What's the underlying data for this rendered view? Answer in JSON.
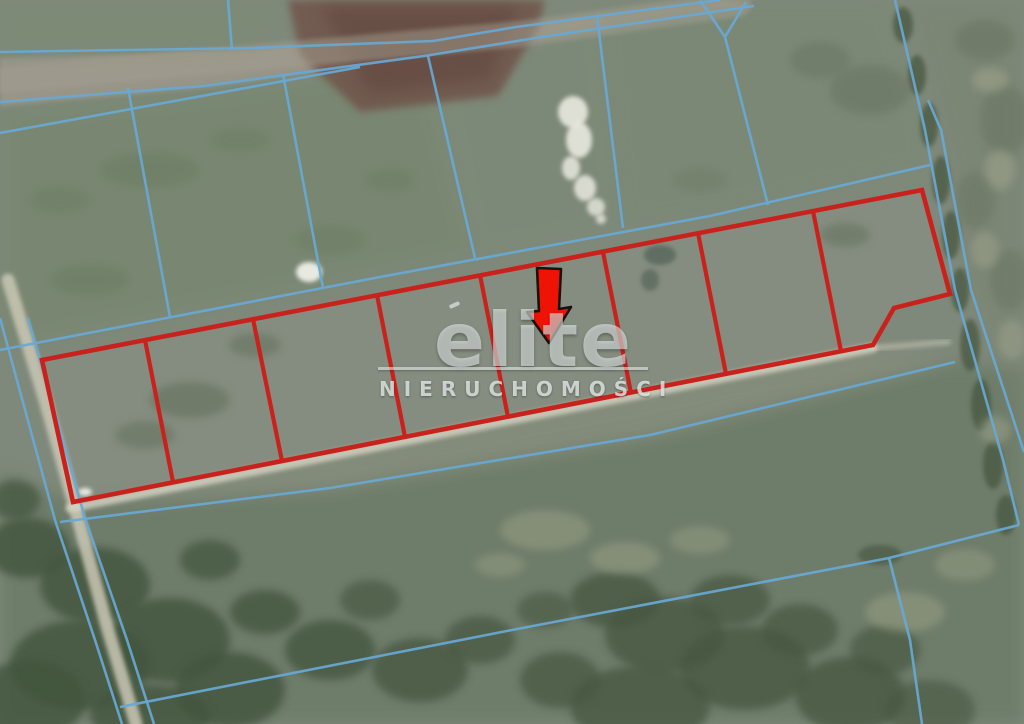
{
  "watermark": {
    "brand": "elite",
    "subtitle": "NIERUCHOMOŚCI"
  },
  "map": {
    "description": "aerial-photo-with-cadastral-overlay",
    "colors": {
      "cadastral": "#68a8d5",
      "parcel": "#c9221d",
      "arrow_fill": "#ef1306",
      "arrow_outline": "#18120c",
      "watermark": "#e6ebe9"
    },
    "parcels": {
      "count": 8,
      "arrow_parcel_index": 5,
      "outline": "42,360 922,190 950,294 894,308 873,345 73,502",
      "dividers": [
        "145,340 173,482",
        "253,319 282,461",
        "377,295 405,437",
        "480,275 508,417",
        "603,252 631,393",
        "698,233 726,374",
        "813,211 841,351"
      ]
    },
    "arrow": {
      "points": "537,268 561,269 559,309 571,307 549,343 527,312 539,311"
    },
    "terrain": {
      "base": "#7f897b",
      "patches": [
        {
          "name": "dirt-road",
          "pts": "0,58 250,50 520,26 722,0 754,6 548,38 424,58 204,88 0,106",
          "fill": "#9b978a",
          "op": 0.95,
          "blur": "b2"
        },
        {
          "name": "field-top-left",
          "pts": "0,112 210,90 425,60 475,255 170,318 0,352",
          "fill": "#75866b",
          "op": 0.5,
          "blur": "b8"
        },
        {
          "name": "field-mid",
          "pts": "428,56 600,16 623,228 475,258",
          "fill": "#7c8b74",
          "op": 0.4,
          "blur": "b8"
        },
        {
          "name": "field-right",
          "pts": "598,14 700,0 888,0 925,130 930,166 768,205 623,228",
          "fill": "#78886f",
          "op": 0.45,
          "blur": "b8"
        },
        {
          "name": "field-above-road",
          "pts": "0,0 285,0 250,50 0,58",
          "fill": "#7c8b72",
          "op": 0.5,
          "blur": "b8"
        },
        {
          "name": "plowed-field",
          "pts": "288,0 545,0 538,28 498,96 360,112 300,55",
          "fill": "#6f5147",
          "op": 0.8,
          "blur": "b4"
        },
        {
          "name": "plowed-field-core",
          "pts": "320,6 520,6 490,80 370,95",
          "fill": "#5c3f37",
          "op": 0.45,
          "blur": "b8"
        },
        {
          "name": "parcel-strip-interior",
          "pts": "42,360 922,190 950,294 894,308 873,345 73,502",
          "fill": "#8c9285",
          "op": 0.5,
          "blur": "b2"
        },
        {
          "name": "bottom-meadow",
          "pts": "0,470 73,502 330,488 650,435 955,362 1024,370 1024,724 0,724",
          "fill": "#64755f",
          "op": 0.6,
          "blur": "b8"
        },
        {
          "name": "east-field",
          "pts": "906,0 941,130 971,290 1024,452 1024,0",
          "fill": "#79836e",
          "op": 0.4,
          "blur": "b8"
        },
        {
          "name": "below-strip-verge",
          "pts": "78,508 873,348 955,362 650,440 330,492",
          "fill": "#8c917c",
          "op": 0.35,
          "blur": "b8"
        }
      ],
      "blobs": [
        [
          28,
          548,
          42,
          30,
          "#42543e",
          0.8,
          "b4"
        ],
        [
          95,
          585,
          55,
          38,
          "#42543e",
          0.8,
          "b4"
        ],
        [
          170,
          640,
          60,
          42,
          "#42543e",
          0.8,
          "b4"
        ],
        [
          80,
          665,
          70,
          45,
          "#42543e",
          0.8,
          "b4"
        ],
        [
          230,
          690,
          55,
          38,
          "#42543e",
          0.8,
          "b4"
        ],
        [
          30,
          700,
          55,
          40,
          "#42543e",
          0.8,
          "b4"
        ],
        [
          150,
          715,
          60,
          30,
          "#42543e",
          0.8,
          "b4"
        ],
        [
          265,
          612,
          35,
          22,
          "#42543e",
          0.75,
          "b4"
        ],
        [
          330,
          650,
          45,
          30,
          "#42543e",
          0.75,
          "b4"
        ],
        [
          210,
          560,
          30,
          20,
          "#42543e",
          0.7,
          "b4"
        ],
        [
          15,
          500,
          25,
          20,
          "#42543e",
          0.7,
          "b4"
        ],
        [
          420,
          670,
          48,
          32,
          "#46573f",
          0.75,
          "b4"
        ],
        [
          480,
          640,
          35,
          24,
          "#46573f",
          0.7,
          "b4"
        ],
        [
          370,
          600,
          30,
          20,
          "#46573f",
          0.65,
          "b4"
        ],
        [
          545,
          610,
          28,
          18,
          "#46573f",
          0.6,
          "b4"
        ],
        [
          615,
          600,
          45,
          28,
          "#46573f",
          0.75,
          "b4"
        ],
        [
          665,
          635,
          60,
          38,
          "#46573f",
          0.75,
          "b4"
        ],
        [
          730,
          600,
          40,
          25,
          "#46573f",
          0.7,
          "b4"
        ],
        [
          745,
          668,
          65,
          42,
          "#46573f",
          0.75,
          "b4"
        ],
        [
          800,
          630,
          38,
          26,
          "#46573f",
          0.7,
          "b4"
        ],
        [
          850,
          695,
          55,
          38,
          "#46573f",
          0.75,
          "b4"
        ],
        [
          885,
          650,
          35,
          25,
          "#46573f",
          0.65,
          "b4"
        ],
        [
          640,
          706,
          70,
          40,
          "#46573f",
          0.75,
          "b4"
        ],
        [
          560,
          680,
          40,
          28,
          "#46573f",
          0.7,
          "b4"
        ],
        [
          930,
          710,
          45,
          30,
          "#46573f",
          0.6,
          "b4"
        ],
        [
          903,
          25,
          10,
          18,
          "#45543d",
          0.7,
          "b2"
        ],
        [
          917,
          75,
          9,
          20,
          "#45543d",
          0.7,
          "b2"
        ],
        [
          929,
          125,
          9,
          22,
          "#45543d",
          0.7,
          "b2"
        ],
        [
          941,
          180,
          9,
          24,
          "#45543d",
          0.7,
          "b2"
        ],
        [
          951,
          235,
          9,
          24,
          "#45543d",
          0.7,
          "b2"
        ],
        [
          960,
          290,
          9,
          22,
          "#45543d",
          0.7,
          "b2"
        ],
        [
          970,
          345,
          10,
          26,
          "#45543d",
          0.7,
          "b2"
        ],
        [
          981,
          405,
          10,
          26,
          "#45543d",
          0.7,
          "b2"
        ],
        [
          993,
          465,
          10,
          24,
          "#45543d",
          0.7,
          "b2"
        ],
        [
          1006,
          515,
          10,
          20,
          "#45543d",
          0.7,
          "b2"
        ],
        [
          880,
          555,
          22,
          10,
          "#45543d",
          0.6,
          "b2"
        ],
        [
          985,
          40,
          30,
          20,
          "#66725f",
          0.5,
          "b4"
        ],
        [
          1005,
          120,
          25,
          35,
          "#66725f",
          0.5,
          "b4"
        ],
        [
          975,
          200,
          20,
          28,
          "#66725f",
          0.45,
          "b4"
        ],
        [
          1010,
          280,
          20,
          30,
          "#66725f",
          0.45,
          "b4"
        ],
        [
          870,
          90,
          40,
          25,
          "#66725f",
          0.5,
          "b4"
        ],
        [
          820,
          60,
          30,
          18,
          "#66725f",
          0.45,
          "b4"
        ],
        [
          990,
          80,
          18,
          12,
          "#a2a78f",
          0.5,
          "b4"
        ],
        [
          1000,
          170,
          15,
          20,
          "#a2a78f",
          0.5,
          "b4"
        ],
        [
          985,
          250,
          14,
          18,
          "#a2a78f",
          0.45,
          "b4"
        ],
        [
          1012,
          340,
          14,
          20,
          "#a2a78f",
          0.45,
          "b4"
        ],
        [
          995,
          430,
          16,
          14,
          "#a2a78f",
          0.45,
          "b4"
        ],
        [
          545,
          530,
          45,
          20,
          "#9ca285",
          0.5,
          "b4"
        ],
        [
          625,
          558,
          35,
          16,
          "#9ca285",
          0.5,
          "b4"
        ],
        [
          905,
          612,
          40,
          20,
          "#9ca285",
          0.5,
          "b4"
        ],
        [
          965,
          565,
          30,
          16,
          "#9ca285",
          0.45,
          "b4"
        ],
        [
          700,
          540,
          30,
          14,
          "#9ca285",
          0.45,
          "b4"
        ],
        [
          500,
          565,
          25,
          12,
          "#9ca285",
          0.45,
          "b4"
        ],
        [
          573,
          112,
          15,
          16,
          "#e9e9e0",
          0.9,
          "b2"
        ],
        [
          579,
          140,
          13,
          18,
          "#e9e9e0",
          0.9,
          "b2"
        ],
        [
          571,
          168,
          9,
          12,
          "#e9e9e0",
          0.85,
          "b2"
        ],
        [
          585,
          188,
          11,
          13,
          "#e9e9e0",
          0.85,
          "b2"
        ],
        [
          596,
          207,
          9,
          9,
          "#e9e9e0",
          0.8,
          "b2"
        ],
        [
          601,
          219,
          5,
          5,
          "#e9e9e0",
          0.8,
          "b2"
        ],
        [
          85,
          492,
          7,
          4,
          "#eef0e8",
          0.95,
          "b2"
        ],
        [
          309,
          272,
          13,
          10,
          "#eef0e8",
          0.95,
          "b2"
        ],
        [
          150,
          170,
          50,
          18,
          "#697a5f",
          0.45,
          "b4"
        ],
        [
          90,
          280,
          40,
          16,
          "#697a5f",
          0.45,
          "b4"
        ],
        [
          330,
          240,
          35,
          15,
          "#697a5f",
          0.4,
          "b4"
        ],
        [
          240,
          140,
          30,
          12,
          "#697a5f",
          0.4,
          "b4"
        ],
        [
          60,
          200,
          30,
          14,
          "#697a5f",
          0.4,
          "b4"
        ],
        [
          390,
          180,
          25,
          12,
          "#697a5f",
          0.4,
          "b4"
        ],
        [
          190,
          400,
          40,
          18,
          "#5d6b55",
          0.5,
          "b4"
        ],
        [
          255,
          345,
          26,
          12,
          "#5d6b55",
          0.45,
          "b4"
        ],
        [
          145,
          435,
          30,
          14,
          "#5d6b55",
          0.45,
          "b4"
        ],
        [
          660,
          255,
          16,
          10,
          "#4a5a50",
          0.6,
          "b2"
        ],
        [
          650,
          280,
          9,
          11,
          "#4a5a50",
          0.55,
          "b2"
        ],
        [
          845,
          235,
          25,
          12,
          "#606f58",
          0.5,
          "b4"
        ],
        [
          700,
          180,
          28,
          13,
          "#6d7c64",
          0.4,
          "b4"
        ]
      ]
    },
    "sand_paths": [
      {
        "d": "M0,80 L520,34 L738,4",
        "w": 26,
        "color": "#a29d8f",
        "op": 0.5
      },
      {
        "d": "M8,280 L45,400 L73,500 L108,630 L136,724",
        "w": 13,
        "color": "#cbc8b6",
        "op": 0.85
      },
      {
        "d": "M70,508 L400,442 L873,348",
        "w": 9,
        "color": "#d8d5c4",
        "op": 0.8
      },
      {
        "d": "M873,348 L948,342",
        "w": 6,
        "color": "#cfccba",
        "op": 0.5
      }
    ],
    "cadastral_lines": [
      "0,52 253,48 433,41 516,27 720,0",
      "0,102 204,86 424,56 548,36 754,6",
      "0,133 180,100 360,67",
      "0,350 380,277 710,216 930,165",
      "128,88 170,317",
      "283,74 323,288",
      "428,56 475,258",
      "597,16 623,228",
      "700,0 725,37 746,2",
      "725,37 768,205",
      "895,0 925,130 955,290 1003,460 1019,525",
      "928,100 941,130 971,290 1024,452",
      "1019,525 889,558 512,630 120,707",
      "889,558 910,640 922,724",
      "60,522 330,488 650,435 955,362",
      "0,318 55,520 95,640 122,724",
      "28,318 85,518 127,640 154,724",
      "228,0 232,50"
    ]
  }
}
